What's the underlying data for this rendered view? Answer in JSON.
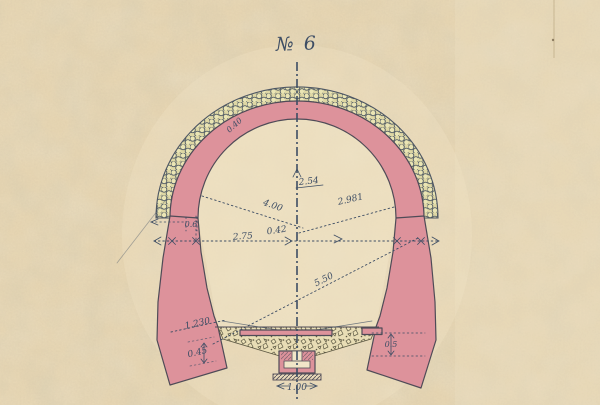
{
  "header": {
    "title": "№ 6"
  },
  "dimensions": {
    "arch_ring_thickness": "0.40",
    "radius_upper": "2.54",
    "radius_right": "2.981",
    "radius_left": "4.00",
    "half_span": "2.75",
    "center_offset": "0.42",
    "wall_top_thickness": "0.6",
    "long_diagonal": "5.50",
    "left_footing_length": "1.230",
    "left_footing_height": "0.45",
    "right_wall_depth": "0.5",
    "drain_width": "1.00"
  },
  "colors": {
    "paper": "#e6d5b2",
    "paper_light": "#f1e5c8",
    "ink": "#3d4d64",
    "outline": "#4f4b57",
    "masonry_pink": "#dd929b",
    "stone_fill": "#eae5b4",
    "stone_bg": "#ded7a4",
    "stone_stroke": "#505a64",
    "gravel_bg": "#e8ddb5",
    "gravel_stone": "#ece1b8",
    "gravel_ink": "#5e5a45"
  }
}
